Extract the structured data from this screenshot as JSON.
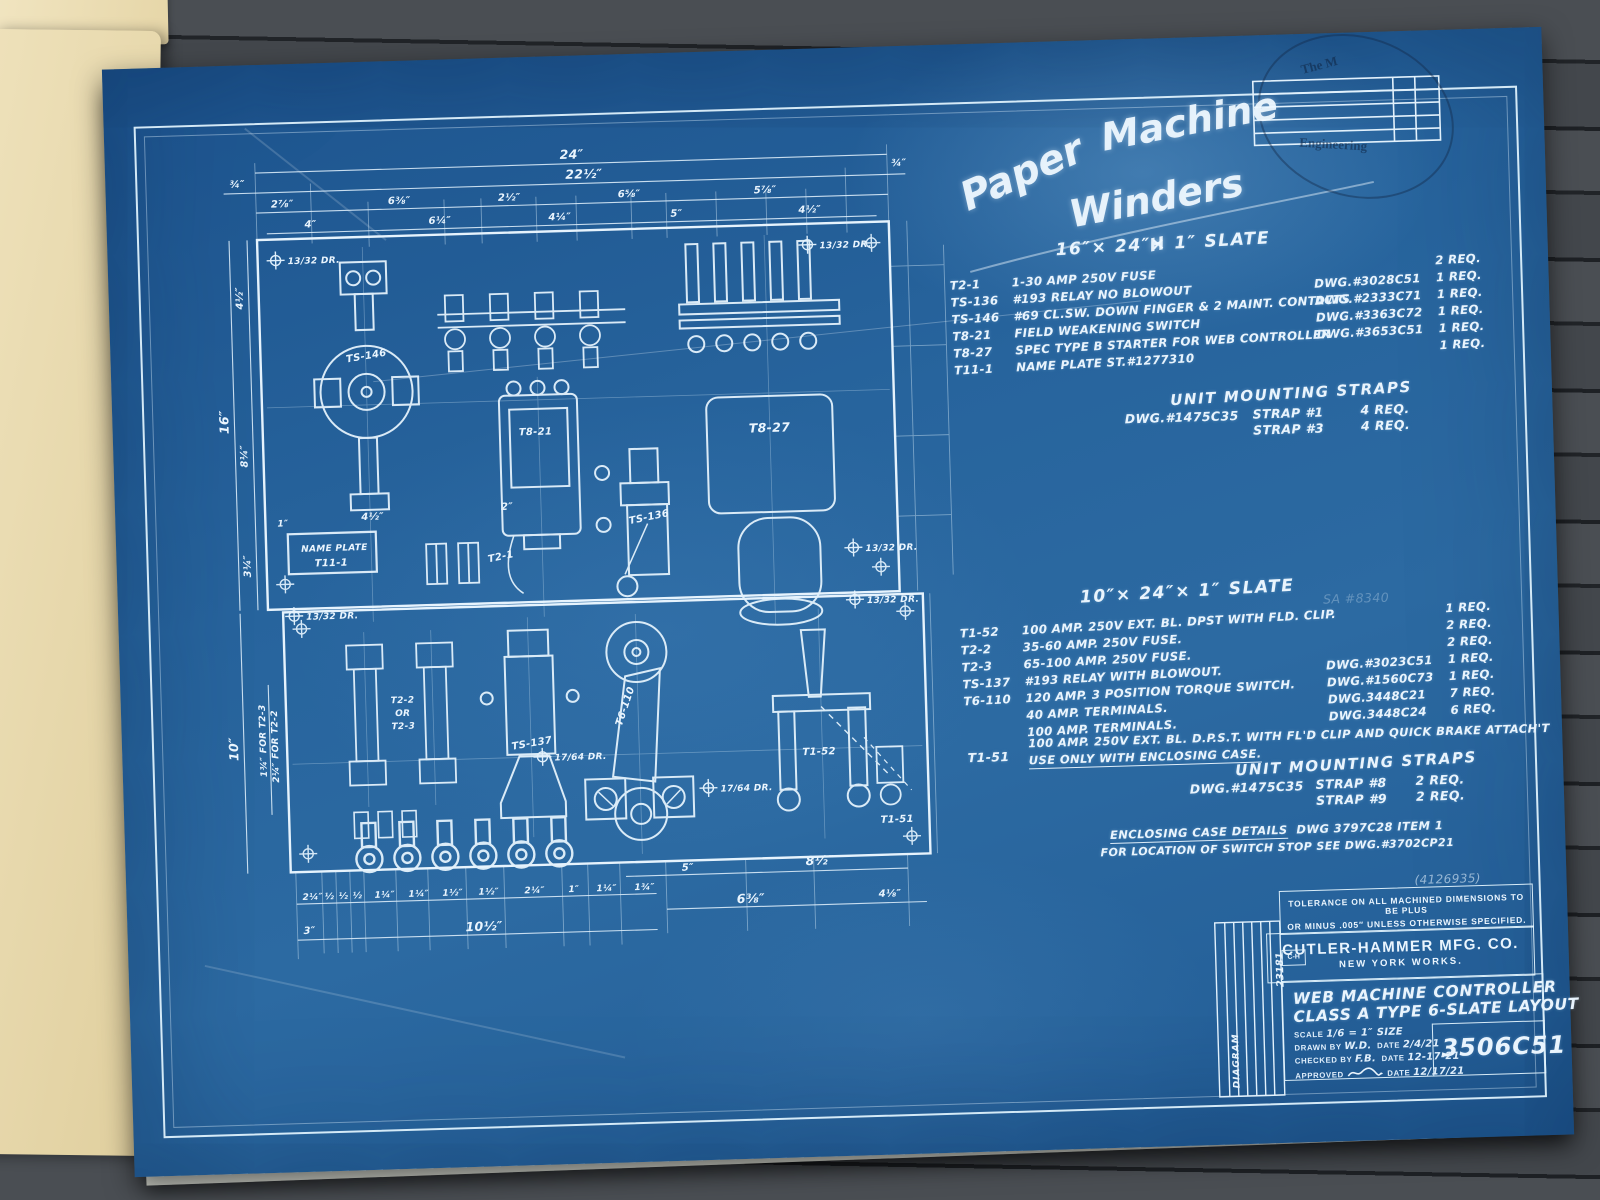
{
  "photo": {
    "deck_color": "#43474b",
    "folder_color": "#eadcb0",
    "under_sheet_color": "#ccd3d3",
    "blueprint_color": "#27649d",
    "ink_color": "#e9f4fd",
    "stamp_ink": "#17304e"
  },
  "handwriting": {
    "w1": "Paper",
    "w2": "Machine",
    "w3": "Winders",
    "w4": "H"
  },
  "stamp": {
    "arc_top": "The M",
    "arc_bottom": "Engineering"
  },
  "pencil": {
    "number": "(4126935)",
    "note": "SA #8340"
  },
  "slate16": {
    "title": "16″× 24″× 1″ SLATE",
    "items": [
      {
        "ref": "T2-1",
        "desc": "1-30 AMP 250V FUSE",
        "dwg": "",
        "req": "2 REQ."
      },
      {
        "ref": "TS-136",
        "desc": "#193 RELAY NO BLOWOUT",
        "dwg": "DWG.#3028C51",
        "req": "1 REQ."
      },
      {
        "ref": "TS-146",
        "desc": "#69 CL.SW. DOWN FINGER & 2 MAINT. CONTACTS",
        "dwg": "DWG.#2333C71",
        "req": "1 REQ."
      },
      {
        "ref": "T8-21",
        "desc": "FIELD WEAKENING SWITCH",
        "dwg": "DWG.#3363C72",
        "req": "1 REQ."
      },
      {
        "ref": "T8-27",
        "desc": "SPEC TYPE B STARTER FOR WEB CONTROLLER",
        "dwg": "DWG.#3653C51",
        "req": "1 REQ."
      },
      {
        "ref": "T11-1",
        "desc": "NAME PLATE ST.#1277310",
        "dwg": "",
        "req": "1 REQ."
      }
    ]
  },
  "straps1": {
    "title": "UNIT MOUNTING STRAPS",
    "dwg": "DWG.#1475C35",
    "rows": [
      {
        "strap": "STRAP #1",
        "req": "4 REQ."
      },
      {
        "strap": "STRAP #3",
        "req": "4 REQ."
      }
    ]
  },
  "slate10": {
    "title": "10″× 24″× 1″ SLATE",
    "items": [
      {
        "ref": "T1-52",
        "desc": "100 AMP. 250V EXT. BL. DPST WITH FLD. CLIP.",
        "dwg": "",
        "req": "1 REQ."
      },
      {
        "ref": "T2-2",
        "desc": "35-60 AMP. 250V FUSE.",
        "dwg": "",
        "req": "2 REQ."
      },
      {
        "ref": "T2-3",
        "desc": "65-100 AMP. 250V FUSE.",
        "dwg": "",
        "req": "2 REQ."
      },
      {
        "ref": "TS-137",
        "desc": "#193 RELAY WITH BLOWOUT.",
        "dwg": "DWG.#3023C51",
        "req": "1 REQ."
      },
      {
        "ref": "T6-110",
        "desc": "120 AMP. 3 POSITION TORQUE SWITCH.",
        "dwg": "DWG.#1560C73",
        "req": "1 REQ."
      },
      {
        "ref": "",
        "desc": "40 AMP. TERMINALS.",
        "dwg": "DWG.3448C21",
        "req": "7 REQ."
      },
      {
        "ref": "",
        "desc": "100 AMP. TERMINALS.",
        "dwg": "DWG.3448C24",
        "req": "6 REQ."
      }
    ],
    "t151_ref": "T1-51",
    "t151_desc": "100 AMP. 250V EXT. BL. D.P.S.T. WITH FL'D CLIP AND QUICK BRAKE ATTACH'T",
    "t151_note": "USE ONLY WITH ENCLOSING CASE."
  },
  "straps2": {
    "title": "UNIT MOUNTING STRAPS",
    "dwg": "DWG.#1475C35",
    "rows": [
      {
        "strap": "STRAP #8",
        "req": "2 REQ."
      },
      {
        "strap": "STRAP #9",
        "req": "2 REQ."
      }
    ]
  },
  "enclosing": {
    "label": "ENCLOSING CASE DETAILS",
    "rest": "DWG 3797C28  ITEM 1",
    "line2": "FOR LOCATION OF SWITCH STOP SEE DWG.#3702CP21"
  },
  "title_block": {
    "tolerance_line1": "TOLERANCE ON ALL MACHINED DIMENSIONS TO BE PLUS",
    "tolerance_line2": "OR MINUS .005″ UNLESS OTHERWISE SPECIFIED.",
    "logo": "C-H",
    "company": "CUTLER-HAMMER MFG. CO.",
    "works": "NEW YORK WORKS.",
    "title_line1": "WEB MACHINE CONTROLLER",
    "title_line2": "CLASS A TYPE 6-SLATE LAYOUT",
    "number": "3506C51",
    "scale_label": "SCALE",
    "scale_value": "1/6 = 1″ SIZE",
    "drawn_label": "DRAWN BY",
    "drawn_value": "W.D.",
    "date_label": "DATE",
    "drawn_date": "2/4/21",
    "checked_label": "CHECKED BY",
    "checked_value": "F.B.",
    "checked_date": "12-17-21",
    "approved_label": "APPROVED",
    "approved_date": "12/17/21",
    "side_number": "23181",
    "side_label": "DIAGRAM"
  },
  "labels": {
    "ts146": "TS-146",
    "t821": "T8-21",
    "t827": "T8-27",
    "ts136": "TS-136",
    "t21": "T2-1",
    "np1": "NAME PLATE",
    "np2": "T11-1",
    "t22": "T2-2",
    "or": "OR",
    "t23": "T2-3",
    "ts137": "TS-137",
    "t6110": "T6-110",
    "t152": "T1-52",
    "t151": "T1-51"
  },
  "dims": {
    "top_row1": "24″",
    "top_row2": [
      "¾″",
      "22½″",
      "¾″"
    ],
    "top_row3": [
      "2⅞″",
      "6⅜″",
      "2½″",
      "6⅝″",
      "5⅞″"
    ],
    "top_row4": [
      "4″",
      "6¼″",
      "4¼″",
      "5″",
      "4½″"
    ],
    "left": [
      "4½″",
      "16″",
      "8¼″",
      "3¼″",
      "10″"
    ],
    "left_note1": "1¾″ FOR T2-3",
    "left_note2": "2¼″ FOR T2-2",
    "plate": [
      "1″",
      "4½″",
      "2″"
    ],
    "bottom_row1": [
      "2¼″",
      "½",
      "½",
      "½",
      "1¼″",
      "1¼″",
      "1½″",
      "1½″",
      "2¼″",
      "1″",
      "1¼″",
      "1¾″"
    ],
    "bottom_row2": [
      "5″",
      "8½″"
    ],
    "bottom_row3": [
      "6⅜″",
      "4⅛″"
    ],
    "bottom_row4": [
      "10½″",
      "3″"
    ],
    "holes": [
      "13/32 DR.",
      "17/64 DR."
    ]
  }
}
